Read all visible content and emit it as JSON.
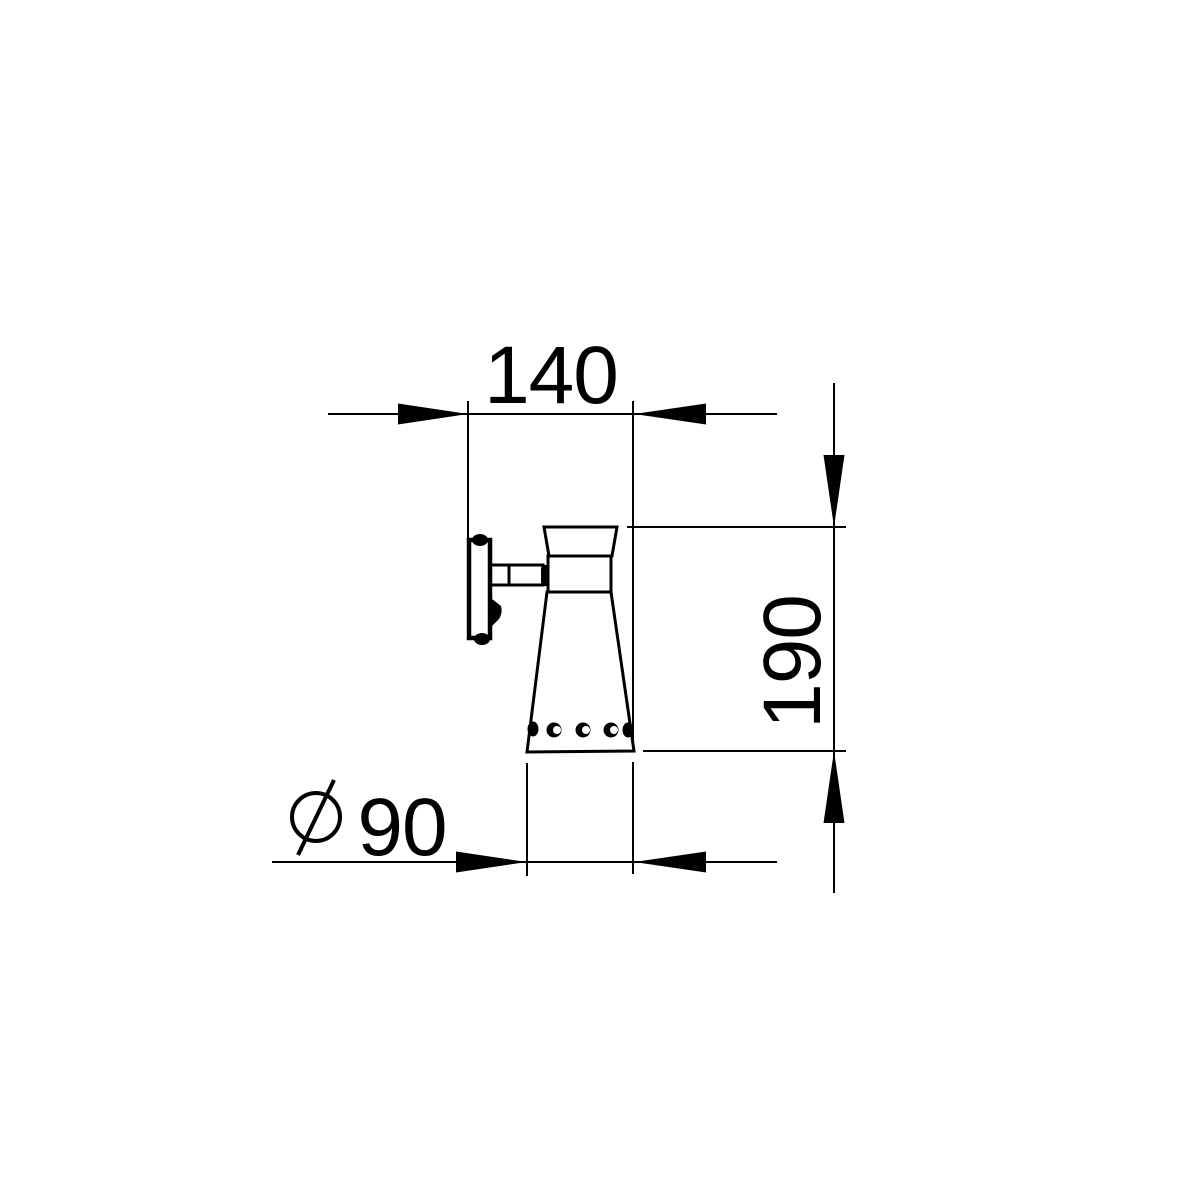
{
  "drawing": {
    "colors": {
      "ink": "#000000",
      "background": "#ffffff"
    }
  },
  "dimensions": {
    "width": {
      "label": "140"
    },
    "height": {
      "label": "190"
    },
    "diameter": {
      "symbol": "⌀",
      "label": "90"
    }
  }
}
